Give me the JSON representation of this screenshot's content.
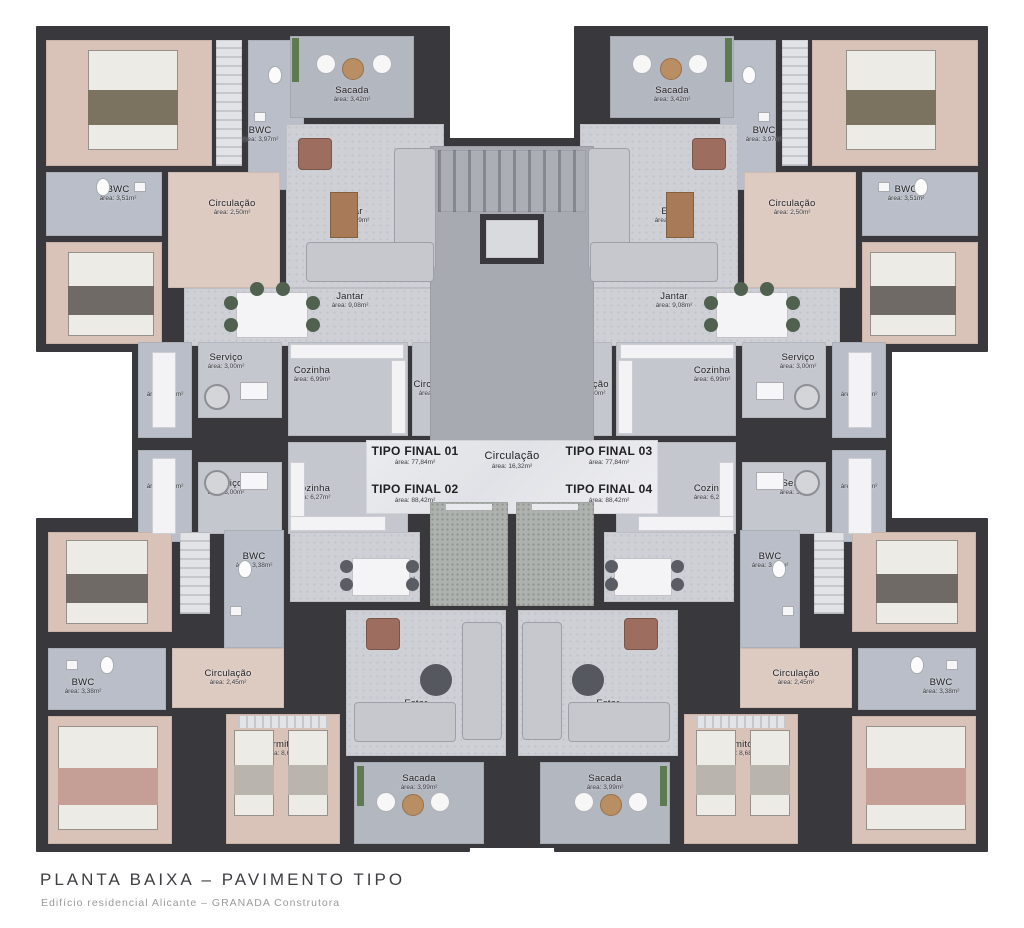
{
  "footer": {
    "title": "PLANTA BAIXA – PAVIMENTO TIPO",
    "subtitle": "Edifício residencial Alicante – GRANADA Construtora"
  },
  "core": {
    "hall": {
      "label": "Circulação",
      "area": "área: 16,32m²"
    }
  },
  "unit_tags": [
    {
      "label": "TIPO FINAL 01",
      "area": "área: 77,84m²"
    },
    {
      "label": "TIPO FINAL 02",
      "area": "área: 88,42m²"
    },
    {
      "label": "TIPO FINAL 03",
      "area": "área: 77,84m²"
    },
    {
      "label": "TIPO FINAL 04",
      "area": "área: 88,42m²"
    }
  ],
  "units": {
    "u1": {
      "rooms": {
        "suite": {
          "label": "Suite",
          "area": "área: 11,04m²"
        },
        "bwc_suite": {
          "label": "BWC",
          "area": "área: 3,97m²"
        },
        "bwc": {
          "label": "BWC",
          "area": "área: 3,51m²"
        },
        "circ": {
          "label": "Circulação",
          "area": "área: 2,50m²"
        },
        "dorm": {
          "label": "Dormitório",
          "area": "área: 9,24m²"
        },
        "sacada": {
          "label": "Sacada",
          "area": "área: 3,42m²"
        },
        "estar": {
          "label": "Estar",
          "area": "área: 9,09m²"
        },
        "jantar": {
          "label": "Jantar",
          "area": "área: 9,08m²"
        },
        "servico": {
          "label": "Serviço",
          "area": "área: 3,00m²"
        },
        "cozinha": {
          "label": "Cozinha",
          "area": "área: 6,99m²"
        },
        "circ2": {
          "label": "Circulação",
          "area": "área: 3,30m²"
        },
        "at": {
          "label": "A.T.",
          "area": "área: 1,80m²"
        }
      }
    },
    "u2": {
      "rooms": {
        "dorm1": {
          "label": "Dormitório",
          "area": "área: 9,75m²"
        },
        "bwc1": {
          "label": "BWC",
          "area": "área: 3,38m²"
        },
        "circ": {
          "label": "Circulação",
          "area": "área: 2,45m²"
        },
        "bwc2": {
          "label": "BWC",
          "area": "área: 3,38m²"
        },
        "suite": {
          "label": "Suite",
          "area": "área: 11,00m²"
        },
        "dorm2": {
          "label": "Dormitório",
          "area": "área: 8,68m²"
        },
        "jantar": {
          "label": "Jantar",
          "area": "área: 11,66m²"
        },
        "estar": {
          "label": "Estar",
          "area": "área: 9,74m²"
        },
        "sacada": {
          "label": "Sacada",
          "area": "área: 3,99m²"
        },
        "servico": {
          "label": "Serviço",
          "area": "área: 3,00m²"
        },
        "cozinha": {
          "label": "Cozinha",
          "area": "área: 6,27m²"
        },
        "at": {
          "label": "A.T.",
          "area": "área: 1,80m²"
        }
      }
    },
    "u3": {
      "rooms": {
        "suite": {
          "label": "Suite",
          "area": "área: 11,04m²"
        },
        "bwc_suite": {
          "label": "BWC",
          "area": "área: 3,97m²"
        },
        "bwc": {
          "label": "BWC",
          "area": "área: 3,51m²"
        },
        "circ": {
          "label": "Circulação",
          "area": "área: 2,50m²"
        },
        "dorm": {
          "label": "Dormitório",
          "area": "área: 9,24m²"
        },
        "sacada": {
          "label": "Sacada",
          "area": "área: 3,42m²"
        },
        "estar": {
          "label": "Estar",
          "area": "área: 9,09m²"
        },
        "jantar": {
          "label": "Jantar",
          "area": "área: 9,08m²"
        },
        "servico": {
          "label": "Serviço",
          "area": "área: 3,00m²"
        },
        "cozinha": {
          "label": "Cozinha",
          "area": "área: 6,99m²"
        },
        "circ2": {
          "label": "Ciculação",
          "area": "área: 3,30m²"
        },
        "at": {
          "label": "A.T.",
          "area": "área: 1,80m²"
        }
      }
    },
    "u4": {
      "rooms": {
        "dorm1": {
          "label": "Dormitório",
          "area": "área: 9,75m²"
        },
        "bwc1": {
          "label": "BWC",
          "area": "área: 3,38m²"
        },
        "circ": {
          "label": "Circulação",
          "area": "área: 2,45m²"
        },
        "bwc2": {
          "label": "BWC",
          "area": "área: 3,38m²"
        },
        "suite": {
          "label": "Suite",
          "area": "área: 11,00m²"
        },
        "dorm2": {
          "label": "Dormitório",
          "area": "área: 8,68m²"
        },
        "jantar": {
          "label": "Jantar",
          "area": "área: 11,19m²"
        },
        "estar": {
          "label": "Estar",
          "area": "área: 9,74m²"
        },
        "sacada": {
          "label": "Sacada",
          "area": "área: 3,99m²"
        },
        "servico": {
          "label": "Serviço",
          "area": "área: 3,00m²"
        },
        "cozinha": {
          "label": "Cozinha",
          "area": "área: 6,27m²"
        },
        "at": {
          "label": "A.T.",
          "area": "área: 1,80m²"
        }
      }
    }
  },
  "colors": {
    "wall": "#38383d",
    "wood_floor": "#d9c2b8",
    "tile_floor": "#c4c7ce",
    "bwc_floor": "#b9bec8",
    "marble_floor": "#e7e8ec",
    "balcony_floor": "#b3b7bf",
    "planter_green": "#5e7a50"
  }
}
